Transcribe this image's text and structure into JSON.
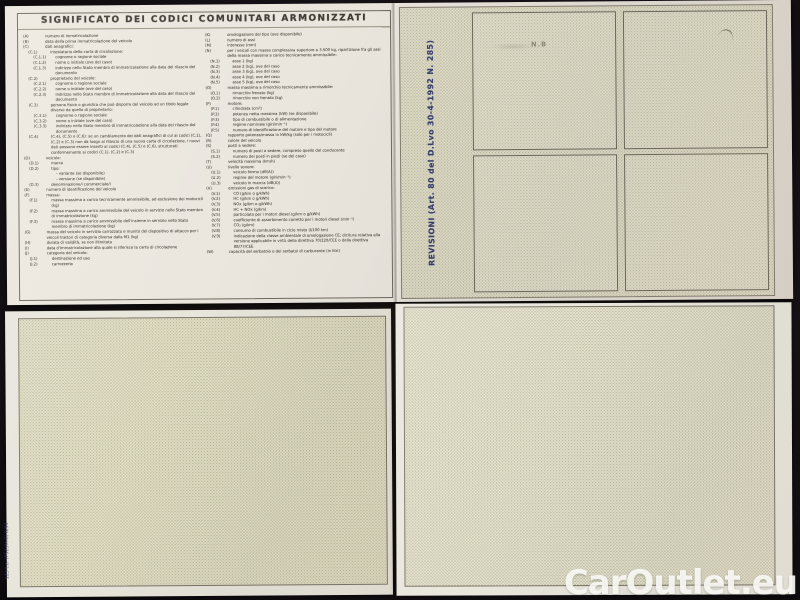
{
  "page": {
    "watermark": "CarOutlet.eu"
  },
  "colors": {
    "background": "#161116",
    "paper": "#e9e5dc",
    "pattern_panel": "#e5e2d0",
    "ink": "#5b564e",
    "title_ink": "#413c35",
    "revisioni_label_navy": "#39406e",
    "watermark": "#fbfaf6"
  },
  "document": {
    "legend": {
      "title": "SIGNIFICATO DEI CODICI COMUNITARI ARMONIZZATI",
      "left_column": [
        [
          0,
          "(A)",
          "numero di immatricolazione"
        ],
        [
          0,
          "(B)",
          "data della prima immatricolazione del veicolo"
        ],
        [
          0,
          "(C)",
          "dati anagrafici:"
        ],
        [
          1,
          "(C.1)",
          "intestatario della carta di circolazione:"
        ],
        [
          2,
          "(C.1.1)",
          "cognome o ragione sociale"
        ],
        [
          2,
          "(C.1.2)",
          "nome o iniziale (ove del caso)"
        ],
        [
          2,
          "(C.1.3)",
          "indirizzo nello Stato membro di immatricolazione alla data del rilascio del documento"
        ],
        [
          1,
          "(C.2)",
          "proprietario del veicolo:"
        ],
        [
          2,
          "(C.2.1)",
          "cognome o ragione sociale"
        ],
        [
          2,
          "(C.2.2)",
          "nome o iniziale (ove del caso)"
        ],
        [
          2,
          "(C.2.3)",
          "indirizzo nello Stato membro di immatricolazione alla data del rilascio del documento"
        ],
        [
          1,
          "(C.3)",
          "persona fisica o giuridica che può disporre del veicolo ad un titolo legale diverso da quello di proprietario:"
        ],
        [
          2,
          "(C.3.1)",
          "cognome o ragione sociale"
        ],
        [
          2,
          "(C.3.2)",
          "nome o iniziale (ove del caso)"
        ],
        [
          2,
          "(C.3.3)",
          "indirizzo nello Stato membro di immatricolazione alla data del rilascio del documento"
        ],
        [
          1,
          "(C.4)",
          "(C.4), (C.5) e (C.6): se un cambiamento dei dati anagrafici di cui ai codici (C.1), (C.2) e (C.3) non dà luogo al rilascio di una nuova carta di circolazione, i nuovi dati possono essere inseriti ai codici (C.4), (C.5) e (C.6), strutturati conformemente ai codici (C.1), (C.2) e (C.3)"
        ],
        [
          0,
          "(D)",
          "veicolo:"
        ],
        [
          1,
          "(D.1)",
          "marca"
        ],
        [
          1,
          "(D.2)",
          "tipo:"
        ],
        [
          2,
          "",
          "- variante (se disponibile)"
        ],
        [
          2,
          "",
          "- versione (se disponibile)"
        ],
        [
          1,
          "(D.3)",
          "denominazione/i commerciale/i"
        ],
        [
          0,
          "(E)",
          "numero di identificazione del veicolo"
        ],
        [
          0,
          "(F)",
          "massa:"
        ],
        [
          1,
          "(F.1)",
          "massa massima a carico tecnicamente ammissibile, ad esclusione dei motocicli (kg)"
        ],
        [
          1,
          "(F.2)",
          "massa massima a carico ammissibile del veicolo in servizio nello Stato membro di immatricolazione (kg)"
        ],
        [
          1,
          "(F.3)",
          "massa massima a carico ammissibile dell'insieme in servizio nello Stato membro di immatricolazione (kg)"
        ],
        [
          0,
          "(G)",
          "massa del veicolo in servizio carrozzato e munito del dispositivo di attacco per i veicoli trattori di categoria diversa dalla M1 (kg)"
        ],
        [
          0,
          "(H)",
          "durata di validità, se non illimitata"
        ],
        [
          0,
          "(I)",
          "data d'immatricolazione alla quale si riferisce la carta di circolazione"
        ],
        [
          0,
          "(J)",
          "categoria del veicolo:"
        ],
        [
          1,
          "(J.1)",
          "destinazione ed uso"
        ],
        [
          1,
          "(J.2)",
          "carrozzeria"
        ]
      ],
      "right_column": [
        [
          0,
          "(K)",
          "omologazione del tipo (ove disponibile)"
        ],
        [
          0,
          "(L)",
          "numero di assi"
        ],
        [
          0,
          "(M)",
          "interasse (mm)"
        ],
        [
          0,
          "(N)",
          "per i veicoli con massa complessiva superiore a 3.500 kg, ripartizione fra gli assi della massa massima a carico tecnicamente ammissibile:"
        ],
        [
          1,
          "(N.1)",
          "asse 1 (kg)"
        ],
        [
          1,
          "(N.2)",
          "asse 2 (kg), ove del caso"
        ],
        [
          1,
          "(N.3)",
          "asse 3 (kg), ove del caso"
        ],
        [
          1,
          "(N.4)",
          "asse 4 (kg), ove del caso"
        ],
        [
          1,
          "(N.5)",
          "asse 5 (kg), ove del caso"
        ],
        [
          0,
          "(O)",
          "massa massima a rimorchio tecnicamente ammissibile:"
        ],
        [
          1,
          "(O.1)",
          "rimorchio frenato (kg)"
        ],
        [
          1,
          "(O.2)",
          "rimorchio non frenato (kg)"
        ],
        [
          0,
          "(P)",
          "motore:"
        ],
        [
          1,
          "(P.1)",
          "cilindrata (cm³)"
        ],
        [
          1,
          "(P.2)",
          "potenza netta massima (kW) (se disponibile)"
        ],
        [
          1,
          "(P.3)",
          "tipo di combustibile o di alimentazione"
        ],
        [
          1,
          "(P.4)",
          "regime nominale (giri/min⁻¹)"
        ],
        [
          1,
          "(P.5)",
          "numero di identificazione del motore e tipo del motore"
        ],
        [
          0,
          "(Q)",
          "rapporto potenza/massa in kW/kg (solo per i motocicli)"
        ],
        [
          0,
          "(R)",
          "colore del veicolo"
        ],
        [
          0,
          "(S)",
          "posti a sedere:"
        ],
        [
          1,
          "(S.1)",
          "numero di posti a sedere, compreso quello del conducente"
        ],
        [
          1,
          "(S.2)",
          "numero dei posti in piedi (se del caso)"
        ],
        [
          0,
          "(T)",
          "velocità massima (km/h)"
        ],
        [
          0,
          "(U)",
          "livello sonoro:"
        ],
        [
          1,
          "(U.1)",
          "veicolo fermo (dB(A))"
        ],
        [
          1,
          "(U.2)",
          "regime del motore (giri/min⁻¹)"
        ],
        [
          1,
          "(U.3)",
          "veicolo in marcia (dB(A))"
        ],
        [
          0,
          "(V)",
          "emissioni gas di scarico:"
        ],
        [
          1,
          "(V.1)",
          "CO (g/km o g/kWh)"
        ],
        [
          1,
          "(V.2)",
          "HC (g/km o g/kWh)"
        ],
        [
          1,
          "(V.3)",
          "NOx (g/km o g/kWh)"
        ],
        [
          1,
          "(V.4)",
          "HC + NOx (g/km)"
        ],
        [
          1,
          "(V.5)",
          "particolato per i motori diesel (g/km o g/kWh)"
        ],
        [
          1,
          "(V.6)",
          "coefficiente di assorbimento corretto per i motori diesel (min⁻¹)"
        ],
        [
          1,
          "(V.7)",
          "CO₂ (g/km)"
        ],
        [
          1,
          "(V.8)",
          "consumo di combustibile in ciclo misto (l/100 km)"
        ],
        [
          1,
          "(V.9)",
          "indicazione della classe ambientale di omologazione CE; dicitura relativa alla versione applicabile in virtù della direttiva 70/220/CEE o della direttiva 88/77/CEE"
        ],
        [
          0,
          "(W)",
          "capacità del serbatoio o dei serbatoi di carburante (in litri)"
        ]
      ]
    },
    "revisioni": {
      "label": "REVISIONI (Art. 80 del D.Lvo 30-4-1992 N. 285)",
      "stamp_box_count": 4,
      "box1_faint_mark": "N.B"
    },
    "print_code": "123 t.o. (P523M.C) 8/94"
  }
}
